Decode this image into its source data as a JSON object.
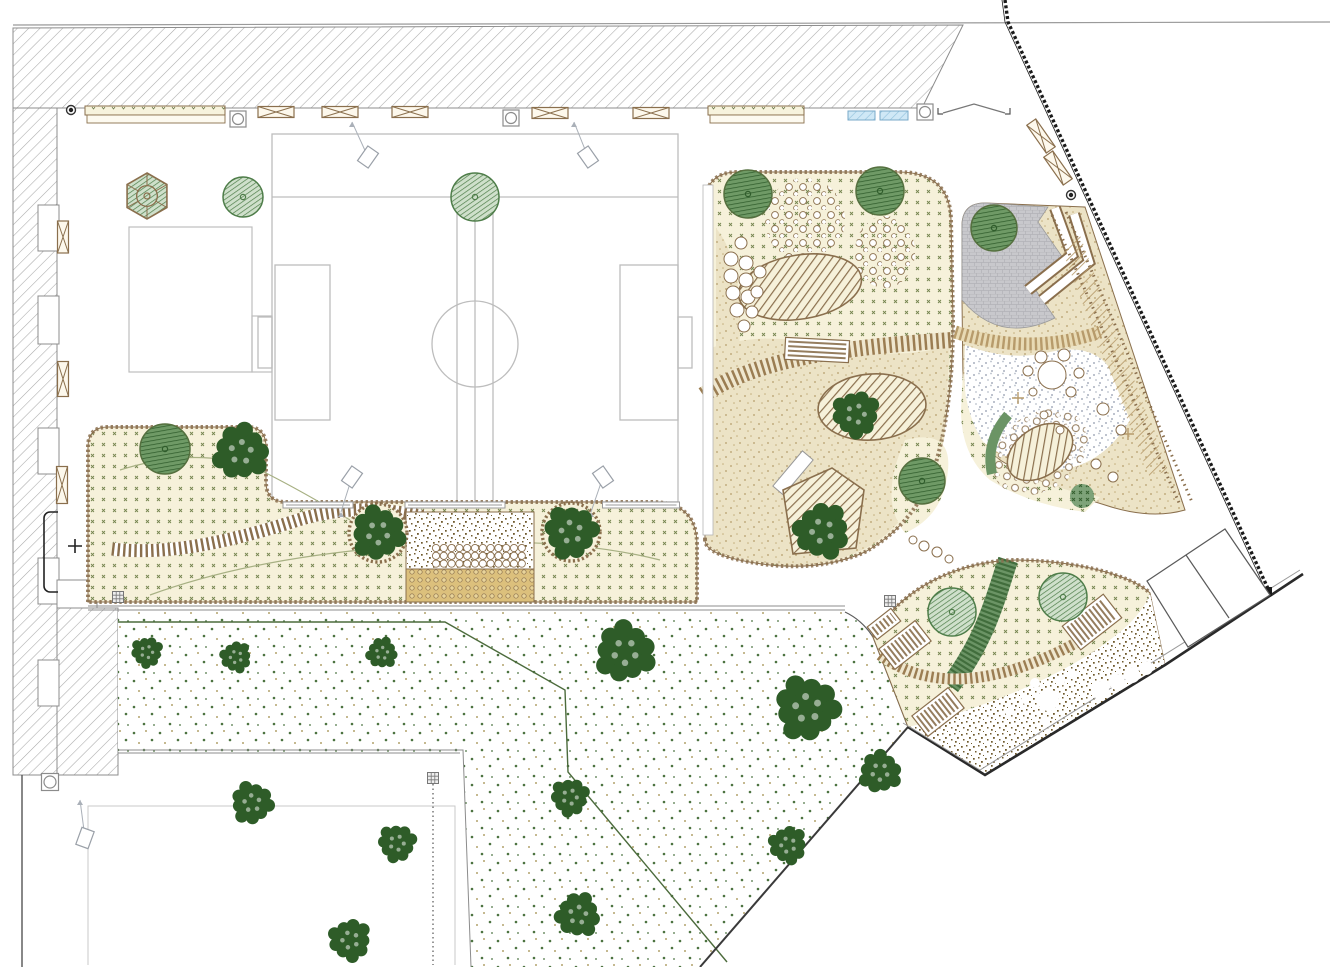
{
  "meta": {
    "kind": "landscape-site-plan",
    "canvas": {
      "w": 1330,
      "h": 967
    },
    "visible_text": ""
  },
  "palette": {
    "line_gray": "#9a9a9a",
    "line_dark": "#2b2b2b",
    "brown": "#8a6f4d",
    "brown_dark": "#6e552f",
    "cream": "#f6f1da",
    "mark_green": "#75854f",
    "sand_bg": "#ece3c6",
    "sand_dot": "#b59e6b",
    "brown_speck": "#6f5a2d",
    "lawn_green": "#4c7340",
    "lawn_tan": "#b3a36d",
    "gray_speck": "#a9b0bf",
    "pave": "#c8c8cc",
    "pave_line": "#b2b2b7",
    "blue": "#cfe8f6",
    "blue_line": "#8fc0dc",
    "gold": "#dcc07c",
    "tree_dark": "#2e5c28",
    "tree_mid_bg": "#cfe0cb",
    "tree_mid_line": "#4e7d49",
    "tree_dk_bg": "#6f9a66",
    "tree_dk_line": "#2f5c2b",
    "band_green": "#6b9465",
    "band_green_dark": "#2f5c2b",
    "contour": "#a7b083",
    "field_line": "#bdbdbd",
    "stripe_tan": "#b79b6b",
    "fence": "#1a1a1a"
  },
  "areas": {
    "building_north": "hatched building block along top",
    "building_west": "hatched building wing along left",
    "sports_field": "double ball court with centre circle and goal boxes",
    "west_garden": "L-shaped planted bed with boardwalk, deck and cobble terrace",
    "play_central": "central playground with mounds, slide structure and sand",
    "play_east": "east playground with paved corner, switchback ramp and boulder field",
    "play_south": "south playground dome with ramps and bark surface",
    "lawn": "large speckled meadow with scattered trees",
    "south_plaza": "white paved plaza bottom left",
    "road_east": "diagonal street with fence and parking bays"
  },
  "trees": [
    {
      "x": 147,
      "y": 196,
      "r": 23,
      "type": "hex"
    },
    {
      "x": 243,
      "y": 197,
      "r": 20,
      "type": "mid"
    },
    {
      "x": 475,
      "y": 197,
      "r": 24,
      "type": "mid"
    },
    {
      "x": 748,
      "y": 194,
      "r": 24,
      "type": "dark"
    },
    {
      "x": 880,
      "y": 191,
      "r": 24,
      "type": "dark"
    },
    {
      "x": 994,
      "y": 228,
      "r": 23,
      "type": "dark"
    },
    {
      "x": 165,
      "y": 449,
      "r": 25,
      "type": "dark"
    },
    {
      "x": 241,
      "y": 452,
      "r": 25,
      "type": "fluffy"
    },
    {
      "x": 378,
      "y": 533,
      "r": 24,
      "type": "fluffy"
    },
    {
      "x": 571,
      "y": 532,
      "r": 24,
      "type": "fluffy"
    },
    {
      "x": 856,
      "y": 414,
      "r": 21,
      "type": "fluffy"
    },
    {
      "x": 822,
      "y": 531,
      "r": 25,
      "type": "fluffy"
    },
    {
      "x": 922,
      "y": 481,
      "r": 23,
      "type": "dark"
    },
    {
      "x": 952,
      "y": 612,
      "r": 24,
      "type": "mid"
    },
    {
      "x": 1063,
      "y": 597,
      "r": 24,
      "type": "mid"
    },
    {
      "x": 147,
      "y": 652,
      "r": 14,
      "type": "fluffy"
    },
    {
      "x": 236,
      "y": 657,
      "r": 14,
      "type": "fluffy"
    },
    {
      "x": 382,
      "y": 653,
      "r": 14,
      "type": "fluffy"
    },
    {
      "x": 625,
      "y": 652,
      "r": 27,
      "type": "fluffy"
    },
    {
      "x": 807,
      "y": 708,
      "r": 29,
      "type": "fluffy"
    },
    {
      "x": 570,
      "y": 797,
      "r": 17,
      "type": "fluffy"
    },
    {
      "x": 788,
      "y": 845,
      "r": 17,
      "type": "fluffy"
    },
    {
      "x": 578,
      "y": 915,
      "r": 20,
      "type": "fluffy"
    },
    {
      "x": 880,
      "y": 772,
      "r": 19,
      "type": "fluffy"
    },
    {
      "x": 252,
      "y": 803,
      "r": 19,
      "type": "fluffy"
    },
    {
      "x": 397,
      "y": 843,
      "r": 17,
      "type": "fluffy"
    },
    {
      "x": 350,
      "y": 940,
      "r": 19,
      "type": "fluffy"
    }
  ],
  "benches": [
    {
      "cx": 276,
      "cy": 112,
      "w": 36,
      "h": 11,
      "rot": 0
    },
    {
      "cx": 340,
      "cy": 112,
      "w": 36,
      "h": 11,
      "rot": 0
    },
    {
      "cx": 410,
      "cy": 112,
      "w": 36,
      "h": 11,
      "rot": 0
    },
    {
      "cx": 550,
      "cy": 113,
      "w": 36,
      "h": 11,
      "rot": 0
    },
    {
      "cx": 651,
      "cy": 113,
      "w": 36,
      "h": 11,
      "rot": 0
    },
    {
      "cx": 63,
      "cy": 237,
      "w": 11,
      "h": 32,
      "rot": 0
    },
    {
      "cx": 63,
      "cy": 379,
      "w": 11,
      "h": 35,
      "rot": 0
    },
    {
      "cx": 62,
      "cy": 485,
      "w": 11,
      "h": 37,
      "rot": 0
    },
    {
      "cx": 1041,
      "cy": 136,
      "w": 34,
      "h": 11,
      "rot": 55
    },
    {
      "cx": 1058,
      "cy": 168,
      "w": 34,
      "h": 11,
      "rot": 55
    }
  ],
  "long_benches": [
    {
      "cx": 318,
      "cy": 505,
      "w": 70
    },
    {
      "cx": 455,
      "cy": 505,
      "w": 100
    },
    {
      "cx": 641,
      "cy": 505,
      "w": 77
    }
  ],
  "planters": [
    {
      "x": 85,
      "y": 106,
      "w": 140
    },
    {
      "x": 708,
      "y": 106,
      "w": 96
    }
  ],
  "bike_racks": [
    {
      "x": 848,
      "y": 111,
      "w": 27
    },
    {
      "x": 880,
      "y": 111,
      "w": 28
    }
  ],
  "tables": [
    {
      "cx": 238,
      "cy": 119
    },
    {
      "cx": 511,
      "cy": 118
    },
    {
      "cx": 925,
      "cy": 112
    }
  ],
  "manholes": [
    {
      "cx": 50,
      "cy": 782
    }
  ],
  "grid_lamps": [
    {
      "cx": 118,
      "cy": 597
    },
    {
      "cx": 433,
      "cy": 778
    },
    {
      "cx": 890,
      "cy": 601
    }
  ],
  "point_markers": [
    {
      "cx": 71,
      "cy": 110
    },
    {
      "cx": 1071,
      "cy": 195
    }
  ],
  "flood_lights": [
    {
      "x": 368,
      "y": 157,
      "rot": 35,
      "tx": 352,
      "ty": 122
    },
    {
      "x": 588,
      "y": 157,
      "rot": -35,
      "tx": 574,
      "ty": 122
    },
    {
      "x": 352,
      "y": 477,
      "rot": 35,
      "tx": 341,
      "ty": 512
    },
    {
      "x": 603,
      "y": 477,
      "rot": -35,
      "tx": 591,
      "ty": 512
    },
    {
      "x": 85,
      "y": 838,
      "rot": 20,
      "tx": 80,
      "ty": 800
    }
  ],
  "deck_grid": {
    "x0": 436,
    "y0": 548,
    "cols": 12,
    "dx": 7.8,
    "rows": 3,
    "dy": 7.8,
    "r": 3.6
  },
  "stone_circles": {
    "central_left": [
      [
        731,
        259,
        7
      ],
      [
        746,
        263,
        7
      ],
      [
        731,
        276,
        7
      ],
      [
        746,
        280,
        7
      ],
      [
        733,
        293,
        7
      ],
      [
        748,
        297,
        7
      ],
      [
        737,
        310,
        7
      ],
      [
        752,
        312,
        6
      ],
      [
        744,
        326,
        6
      ],
      [
        757,
        292,
        6
      ],
      [
        760,
        272,
        6
      ],
      [
        741,
        243,
        6
      ]
    ],
    "central_bottom": [
      [
        913,
        540,
        4
      ],
      [
        924,
        546,
        5
      ],
      [
        937,
        552,
        5
      ],
      [
        949,
        559,
        4
      ]
    ],
    "east_mid": [
      [
        1052,
        375,
        14
      ],
      [
        1041,
        357,
        6
      ],
      [
        1064,
        355,
        6
      ],
      [
        1028,
        371,
        5
      ],
      [
        1079,
        373,
        5
      ],
      [
        1071,
        392,
        5
      ],
      [
        1033,
        392,
        4
      ],
      [
        1103,
        409,
        6
      ],
      [
        1121,
        430,
        5
      ],
      [
        1096,
        464,
        5
      ],
      [
        1113,
        477,
        5
      ],
      [
        1060,
        430,
        4
      ],
      [
        1044,
        415,
        4
      ]
    ],
    "south_brown": [
      [
        1048,
        700,
        11
      ],
      [
        1100,
        690,
        9
      ],
      [
        1117,
        682,
        8
      ],
      [
        1132,
        675,
        8
      ],
      [
        1146,
        668,
        7
      ],
      [
        1035,
        683,
        5
      ],
      [
        1060,
        681,
        5
      ],
      [
        1072,
        674,
        4
      ],
      [
        1046,
        721,
        4
      ],
      [
        1025,
        700,
        4
      ],
      [
        1009,
        712,
        4
      ]
    ]
  },
  "ramps": [
    {
      "cx": 905,
      "cy": 645,
      "w": 46,
      "h": 26,
      "rot": -38
    },
    {
      "cx": 938,
      "cy": 712,
      "w": 46,
      "h": 26,
      "rot": -38
    },
    {
      "cx": 1092,
      "cy": 622,
      "w": 52,
      "h": 30,
      "rot": -38
    },
    {
      "cx": 884,
      "cy": 624,
      "w": 30,
      "h": 16,
      "rot": -38
    },
    {
      "cx": 817,
      "cy": 350,
      "w": 22,
      "h": 64,
      "rot": 93
    }
  ],
  "field": {
    "outer": {
      "x": 272,
      "y": 134,
      "w": 406,
      "h": 368
    },
    "top_line_y": 197,
    "corridor_x": [
      457,
      475,
      493
    ],
    "centre_circle": {
      "cx": 475,
      "cy": 344,
      "r": 43
    },
    "left_box": {
      "x": 275,
      "y": 265,
      "w": 55,
      "h": 155
    },
    "right_box": {
      "x": 620,
      "y": 265,
      "w": 58,
      "h": 155
    },
    "left_goal": {
      "x": 258,
      "y": 317,
      "w": 14,
      "h": 51
    },
    "right_goal": {
      "x": 678,
      "y": 317,
      "w": 14,
      "h": 51
    }
  },
  "court_rect": {
    "x": 129,
    "y": 227,
    "w": 123,
    "h": 145,
    "annex": {
      "x": 252,
      "y": 316,
      "w": 20,
      "h": 56
    }
  },
  "parking": {
    "outer": [
      [
        1147,
        581
      ],
      [
        1225,
        529
      ],
      [
        1270,
        595
      ],
      [
        1188,
        647
      ]
    ],
    "divider": [
      [
        1186,
        555
      ],
      [
        1229,
        618
      ]
    ]
  }
}
